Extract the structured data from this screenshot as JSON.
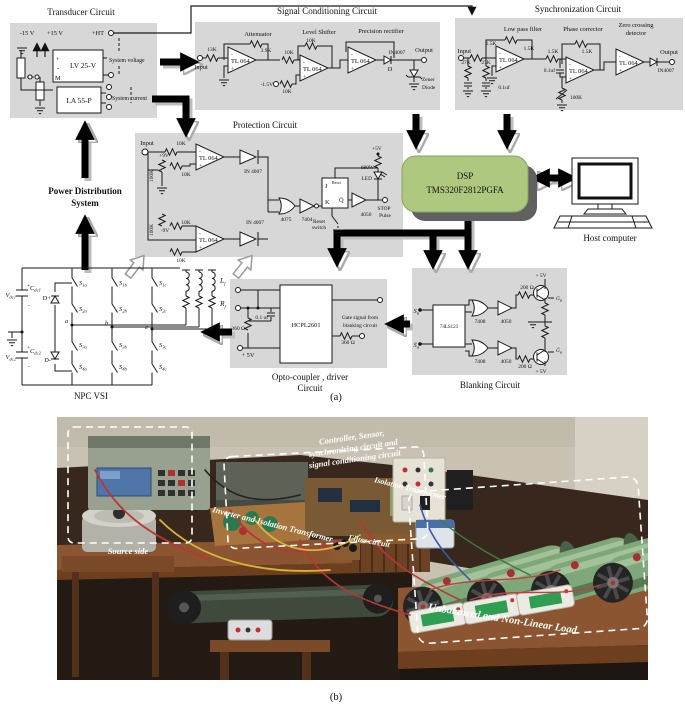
{
  "figure": {
    "caption_a": "(a)",
    "caption_b": "(b)"
  },
  "colors": {
    "block_bg": "#d7d7d7",
    "dsp_green": "#aec87f",
    "dsp_shadow": "#606060",
    "arrow": "#000000",
    "wall": "#c9c2b3",
    "wood": "#38271c",
    "table": "#8a5530",
    "rheostat_green": "#7fa87a"
  },
  "transducer": {
    "title": "Transducer Circuit",
    "v_neg": "-15 V",
    "v_pos": "+15 V",
    "ht": "+HT",
    "lv": "LV 25-V",
    "la": "LA 55-P",
    "m": "M",
    "plus": "+",
    "minus": "-",
    "system_voltage": "System voltage",
    "system_current": "System current"
  },
  "pds": {
    "line1": "Power Distribution",
    "line2": "System"
  },
  "sc": {
    "title": "Signal Conditioning Circuit",
    "attenuator": "Attenuator",
    "level_shifter": "Level Shifter",
    "precision_rectifier": "Precision rectifier",
    "input": "Input",
    "r13k": "13K",
    "r39k": "3.9K",
    "amp": "TL 064",
    "r10k": "10K",
    "r10k_fb": "10K",
    "r10k_dn": "10K",
    "v_offset": "-1.5V",
    "diode": "IN4007",
    "d": "D",
    "output": "Output",
    "zener1": "Zener",
    "zener2": "Diode"
  },
  "sy": {
    "title": "Synchronization Circuit",
    "lpf": "Low pass filter",
    "phase": "Phase corrector",
    "zcd1": "Zero crossing",
    "zcd2": "detector",
    "input": "Input",
    "r1": "1.5K",
    "r2": "1.5K",
    "r27a": "27K",
    "r27b": "27K",
    "c1": "0.1uf",
    "amp": "TL 064",
    "r3": "1.5K",
    "r4": "1.5K",
    "c2": "0.1uf",
    "pot": "100K",
    "diode": "IN4007",
    "output": "Output"
  },
  "pt": {
    "title": "Protection Circuit",
    "input": "Input",
    "r10k": "10K",
    "r10k2": "10K",
    "r10k3": "10K",
    "r10k4": "10K",
    "r100k": "100K",
    "r100k2": "100K",
    "p9v": "+9V",
    "n9v": "-9V",
    "amp": "TL 064",
    "d1": "IN 4007",
    "d2": "IN 4007",
    "or_gate": "4075",
    "inv": "7404",
    "j": "J",
    "reset": "Reset",
    "k": "K",
    "q": "Q̄",
    "rsw1": "Reset",
    "rsw2": "switch",
    "p5v": "+5V",
    "r680": "680W",
    "led": "LED",
    "buf": "4050",
    "stop": "STOP",
    "pulse": "Pulse"
  },
  "dsp": {
    "line1": "DSP",
    "line2": "TMS320F2812PGFA",
    "host": "Host computer"
  },
  "npc": {
    "caption": "NPC VSI",
    "v_base": "V",
    "c_base": "C",
    "sub_dc1": "dc1",
    "sub_dc2": "dc2",
    "plus": "+",
    "minus": "-",
    "dp": "D+",
    "dn": "D-",
    "s_base": "S",
    "s_subs": [
      "1a",
      "2a",
      "3a",
      "4a",
      "1b",
      "2b",
      "3b",
      "4b",
      "1c",
      "2c",
      "3c",
      "4c"
    ],
    "ph_a": "a",
    "ph_b": "b",
    "ph_c": "c",
    "l_base": "L",
    "r_base": "R",
    "sub_f": "f"
  },
  "oc": {
    "caption1": "Opto-coupler , driver",
    "caption2": "Circuit",
    "ic": "HCPL2601",
    "cap": "0.1 uf",
    "r_left": "360 Ω",
    "p5v": "+ 5V",
    "gate1": "Gate signal from",
    "gate2": "blanking circuit",
    "r_right": "360 Ω"
  },
  "bl": {
    "caption": "Blanking Circuit",
    "ic": "74LS123",
    "s_base": "S",
    "sbar_base": "S̄",
    "sub_a": "a",
    "g1": "7408",
    "g2": "7408",
    "b1": "4050",
    "b2": "4050",
    "r1": "200 Ω",
    "r2": "200 Ω",
    "p5v_top": "+ 5V",
    "p5v_bot": "+ 5V",
    "g_base": "G",
    "gbar_base": "Ḡ"
  },
  "photo": {
    "source_side": "Source side",
    "controller1": "Controller, Sensor,",
    "controller2": "synchronising circuit and",
    "controller3": "signal conditioning circuit",
    "inverter": "Inverter and Isolation Transformer",
    "isolation": "Isolation Transformer",
    "filter": "Filter circuit",
    "load": "Unbalanced and Non-Linear Load"
  }
}
